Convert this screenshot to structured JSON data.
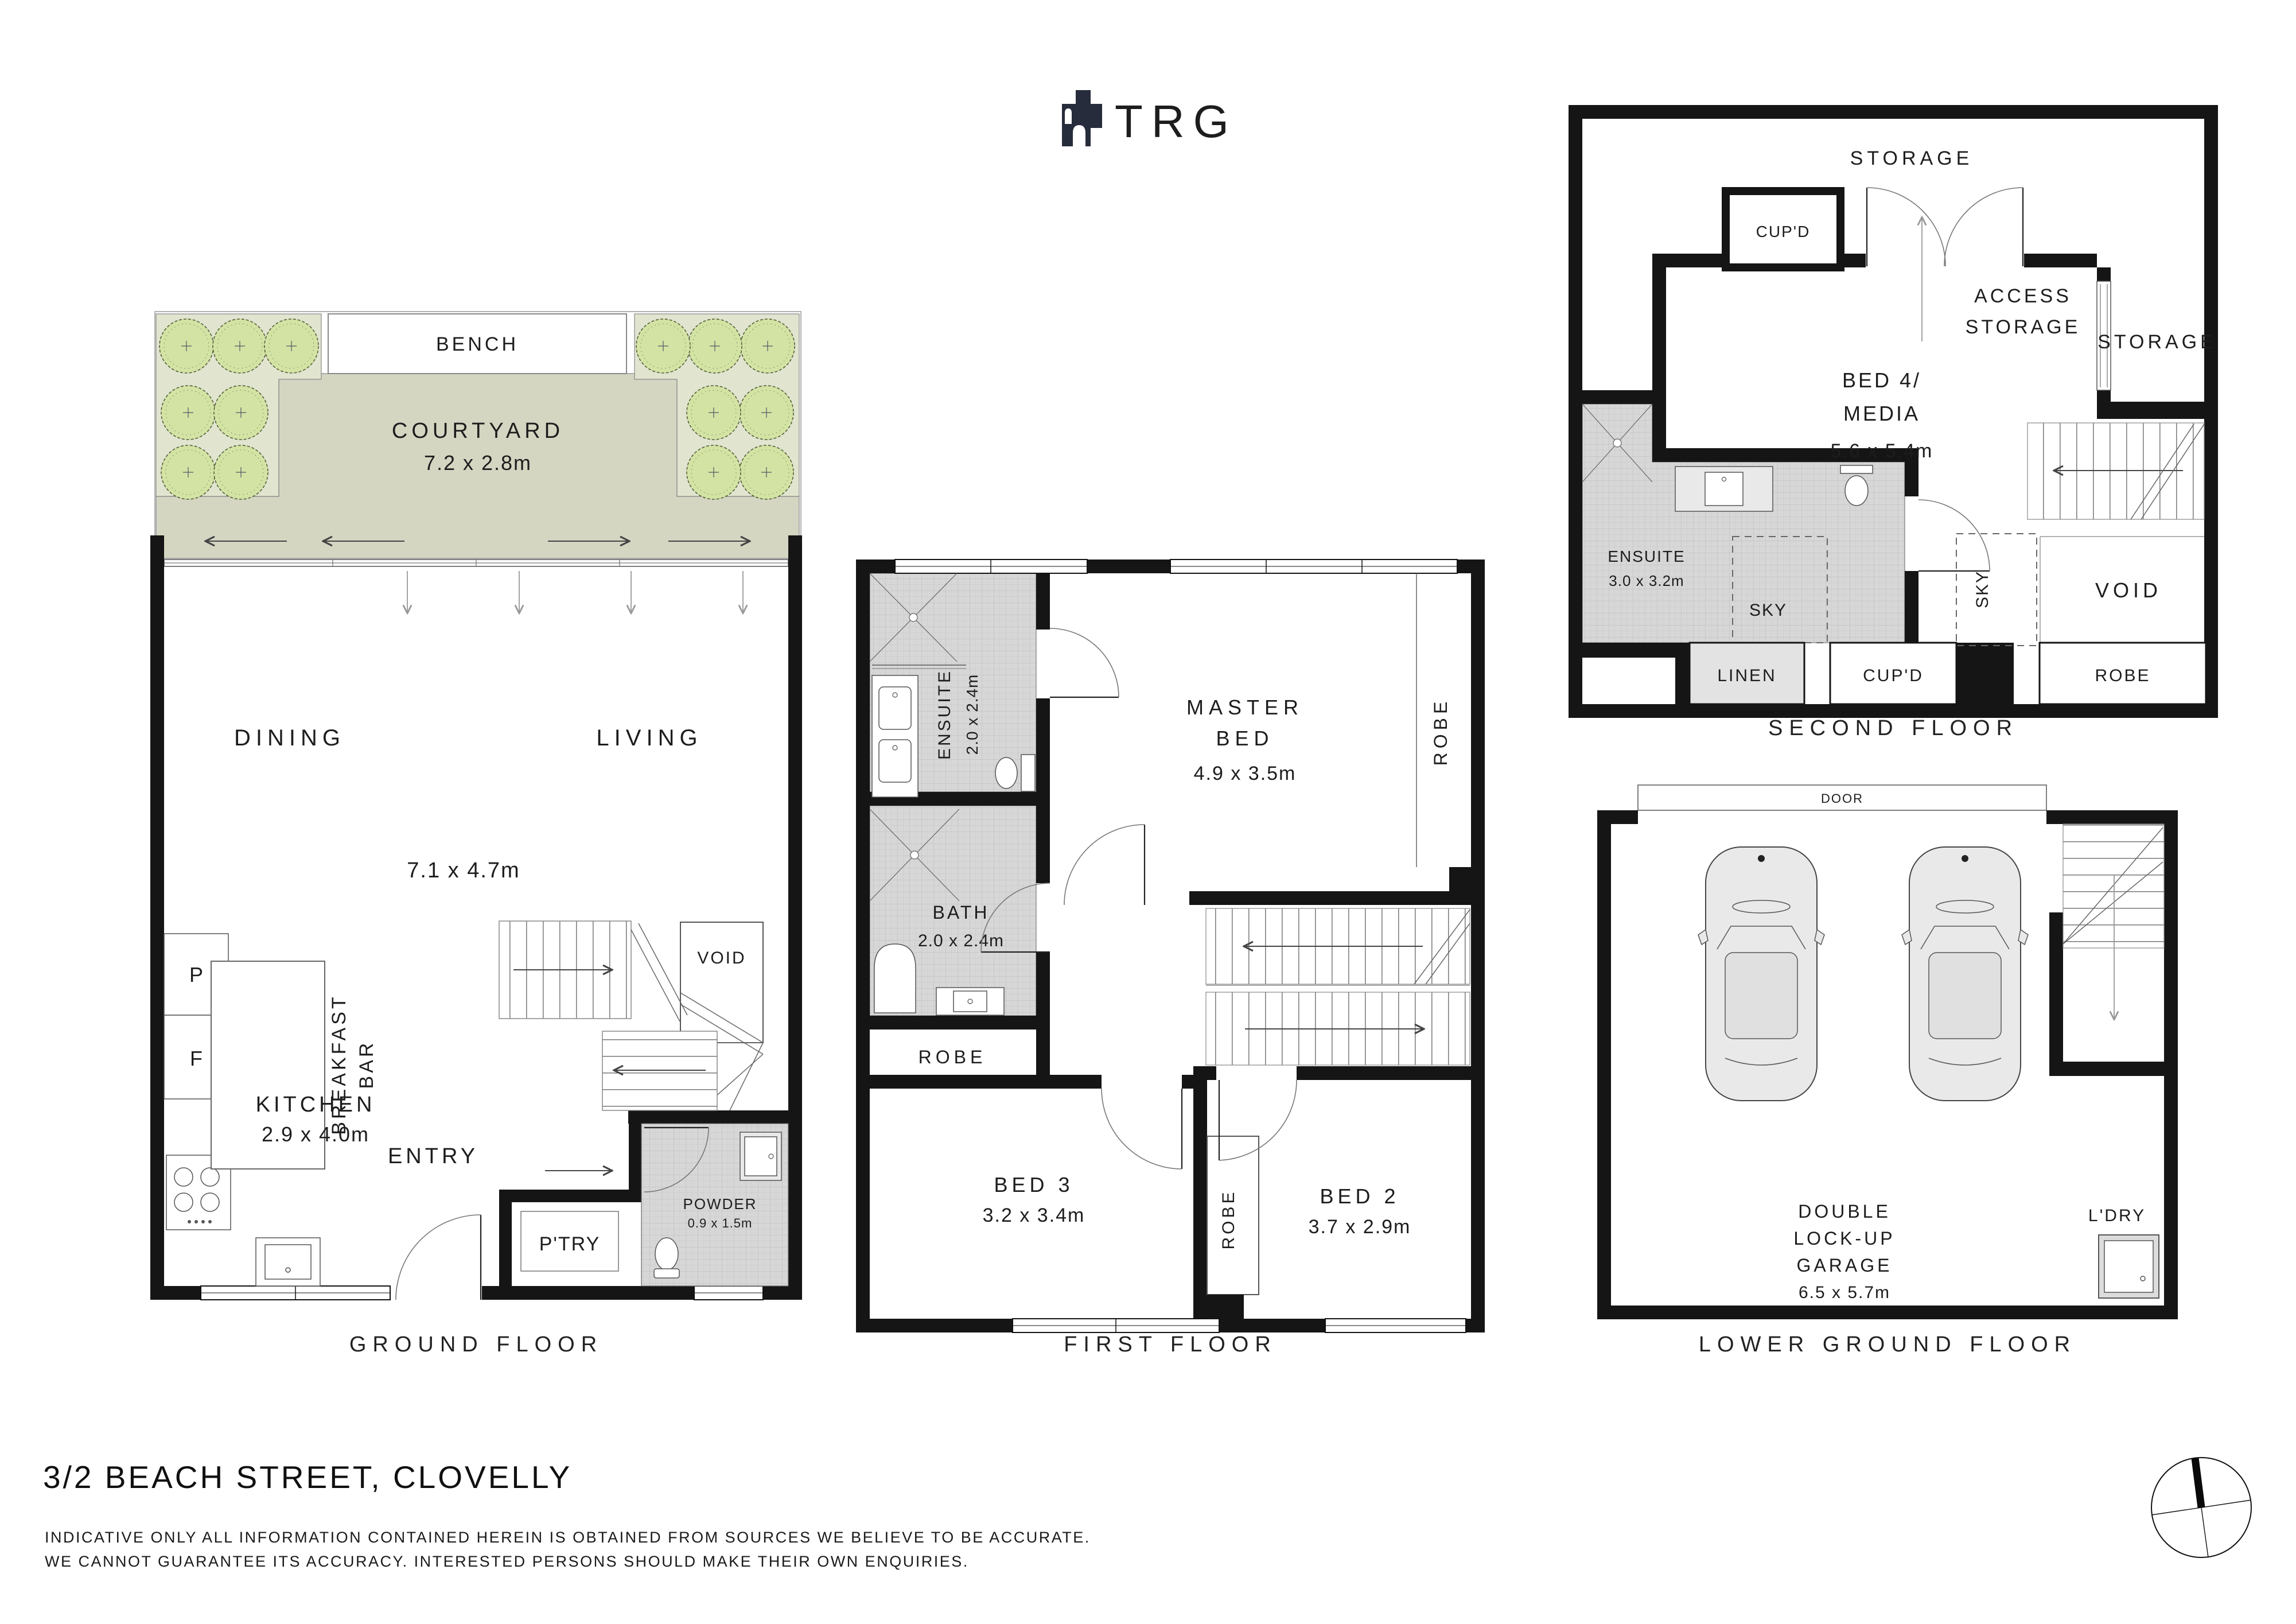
{
  "logo": {
    "brand": "TRG"
  },
  "floors": {
    "ground": {
      "title": "GROUND FLOOR",
      "bench": "BENCH",
      "courtyard_name": "COURTYARD",
      "courtyard_dim": "7.2 x 2.8m",
      "dining": "DINING",
      "living": "LIVING",
      "living_dim": "7.1 x 4.7m",
      "pantry_abbr": "P",
      "fridge_abbr": "F",
      "breakfast_line1": "BREAKFAST",
      "breakfast_line2": "BAR",
      "kitchen_name": "KITCHEN",
      "kitchen_dim": "2.9 x 4.0m",
      "entry": "ENTRY",
      "ptry": "P'TRY",
      "powder_name": "POWDER",
      "powder_dim": "0.9 x 1.5m",
      "void": "VOID"
    },
    "first": {
      "title": "FIRST FLOOR",
      "ensuite_name": "ENSUITE",
      "ensuite_dim": "2.0 x 2.4m",
      "bath_name": "BATH",
      "bath_dim": "2.0 x 2.4m",
      "robe_left": "ROBE",
      "master_line1": "MASTER",
      "master_line2": "BED",
      "master_dim": "4.9 x 3.5m",
      "robe_right": "ROBE",
      "bed3_name": "BED 3",
      "bed3_dim": "3.2 x 3.4m",
      "robe_mid": "ROBE",
      "bed2_name": "BED 2",
      "bed2_dim": "3.7 x 2.9m"
    },
    "second": {
      "title": "SECOND FLOOR",
      "storage_top": "STORAGE",
      "cupd_top": "CUP'D",
      "access_line1": "ACCESS",
      "access_line2": "STORAGE",
      "bed4_line1": "BED 4/",
      "bed4_line2": "MEDIA",
      "bed4_dim": "5.6 x 5.4m",
      "storage_right": "STORAGE",
      "ensuite_name": "ENSUITE",
      "ensuite_dim": "3.0 x 3.2m",
      "sky_ensuite": "SKY",
      "sky_mid": "SKY",
      "void": "VOID",
      "linen": "LINEN",
      "cupd_bottom": "CUP'D",
      "robe": "ROBE"
    },
    "lower": {
      "title": "LOWER GROUND FLOOR",
      "door": "DOOR",
      "garage_line1": "DOUBLE",
      "garage_line2": "LOCK-UP",
      "garage_line3": "GARAGE",
      "garage_dim": "6.5 x 5.7m",
      "ldry": "L'DRY"
    }
  },
  "footer": {
    "address": "3/2 BEACH STREET, CLOVELLY",
    "disclaimer_line1": "INDICATIVE ONLY ALL INFORMATION CONTAINED HEREIN IS OBTAINED FROM SOURCES WE BELIEVE TO BE ACCURATE.",
    "disclaimer_line2": "WE CANNOT GUARANTEE ITS ACCURACY. INTERESTED PERSONS SHOULD MAKE THEIR OWN ENQUIRIES."
  },
  "colors": {
    "wall": "#151515",
    "tile": "#d7d7d7",
    "courtyard_floor": "#d5d6c2",
    "planting_bed": "#e1e4cf",
    "tree": "#d3e3a4",
    "logo_navy": "#262c3b"
  }
}
